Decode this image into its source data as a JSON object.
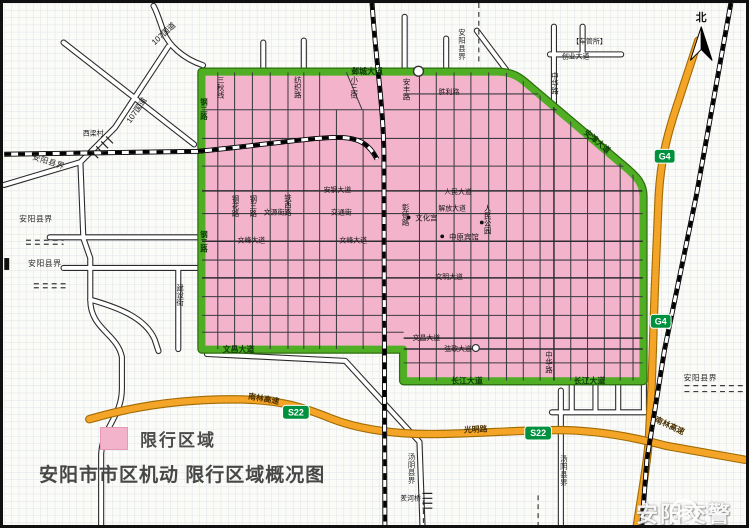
{
  "title": "安阳市市区机动 限行区域概况图",
  "legend": {
    "label": "限行区域",
    "swatch_color": "#f3b3cb"
  },
  "watermark": {
    "text": "安阳交警"
  },
  "compass": {
    "label": "北"
  },
  "map": {
    "colors": {
      "restricted_zone_fill": "#f3b3cb",
      "boundary_road_green": "#4fae24",
      "highway_orange": "#f4a427",
      "badge_green": "#00913f",
      "paper_grid": "#dee3e7"
    },
    "badges": [
      {
        "text": "G4",
        "x": 668,
        "y": 155
      },
      {
        "text": "G4",
        "x": 664,
        "y": 322
      },
      {
        "text": "S22",
        "x": 295,
        "y": 414
      },
      {
        "text": "S22",
        "x": 540,
        "y": 435
      }
    ],
    "pois": [
      {
        "x": 409,
        "y": 217
      },
      {
        "x": 443,
        "y": 236
      },
      {
        "x": 483,
        "y": 222
      }
    ],
    "labels": [
      {
        "text": "107国道",
        "x": 163,
        "y": 33,
        "rot": -42,
        "c": "r"
      },
      {
        "text": "107国道",
        "x": 136,
        "y": 110,
        "rot": -55,
        "c": "r"
      },
      {
        "text": "西梁村",
        "x": 90,
        "y": 134,
        "c": "r t"
      },
      {
        "text": "安阳县界",
        "x": 44,
        "y": 163,
        "rot": 17,
        "c": "b"
      },
      {
        "text": "安阳县界",
        "x": 32,
        "y": 221,
        "c": "b"
      },
      {
        "text": "安阳县界",
        "x": 41,
        "y": 266,
        "c": "b"
      },
      {
        "text": "安阳县界",
        "x": 463,
        "y": 26,
        "v": 1,
        "c": "b"
      },
      {
        "text": "安阳县界",
        "x": 704,
        "y": 382,
        "c": "b"
      },
      {
        "text": "汤阴县界",
        "x": 412,
        "y": 455,
        "v": 1,
        "c": "b"
      },
      {
        "text": "汤阴县界",
        "x": 566,
        "y": 457,
        "v": 1,
        "c": "b"
      },
      {
        "text": "邺城大道",
        "x": 367,
        "y": 72,
        "c": "g"
      },
      {
        "text": "钢二路",
        "x": 202,
        "y": 96,
        "v": 1,
        "c": "g"
      },
      {
        "text": "钢二路",
        "x": 202,
        "y": 230,
        "v": 1,
        "c": "g"
      },
      {
        "text": "文昌大道",
        "x": 237,
        "y": 353,
        "c": "g"
      },
      {
        "text": "长江大道",
        "x": 468,
        "y": 385,
        "c": "g"
      },
      {
        "text": "长江大道",
        "x": 592,
        "y": 385,
        "c": "g"
      },
      {
        "text": "安漳大道",
        "x": 598,
        "y": 142,
        "rot": 40,
        "c": "g"
      },
      {
        "text": "中华路",
        "x": 557,
        "y": 70,
        "v": 1,
        "c": "r"
      },
      {
        "text": "中华路",
        "x": 551,
        "y": 352,
        "v": 1,
        "c": "r"
      },
      {
        "text": "安丰路",
        "x": 407,
        "y": 76,
        "v": 1,
        "c": "r"
      },
      {
        "text": "胜利路",
        "x": 450,
        "y": 92,
        "c": "r t"
      },
      {
        "text": "纺织路",
        "x": 297,
        "y": 74,
        "v": 1,
        "c": "r"
      },
      {
        "text": "三秋线",
        "x": 219,
        "y": 74,
        "v": 1,
        "c": "r"
      },
      {
        "text": "小三街",
        "x": 354,
        "y": 74,
        "v": 1,
        "c": "r"
      },
      {
        "text": "安钢大道",
        "x": 337,
        "y": 191,
        "c": "r t"
      },
      {
        "text": "人民大道",
        "x": 459,
        "y": 193,
        "c": "r t"
      },
      {
        "text": "解放大道",
        "x": 453,
        "y": 210,
        "c": "r t"
      },
      {
        "text": "文峰大道",
        "x": 250,
        "y": 242,
        "c": "r t"
      },
      {
        "text": "文峰大道",
        "x": 353,
        "y": 242,
        "c": "r t"
      },
      {
        "text": "文明大道",
        "x": 450,
        "y": 279,
        "c": "r t"
      },
      {
        "text": "文昌大道",
        "x": 427,
        "y": 341,
        "c": "r t"
      },
      {
        "text": "弦歌大道",
        "x": 459,
        "y": 352,
        "c": "r t"
      },
      {
        "text": "文源街",
        "x": 273,
        "y": 214,
        "c": "r t"
      },
      {
        "text": "交通街",
        "x": 341,
        "y": 214,
        "c": "r t"
      },
      {
        "text": "铁西路",
        "x": 287,
        "y": 193,
        "v": 1,
        "c": "r"
      },
      {
        "text": "彰德路",
        "x": 406,
        "y": 203,
        "v": 1,
        "c": "r"
      },
      {
        "text": "钢花路",
        "x": 234,
        "y": 194,
        "v": 1,
        "c": "r"
      },
      {
        "text": "钢三路",
        "x": 252,
        "y": 194,
        "v": 1,
        "c": "r"
      },
      {
        "text": "建设街",
        "x": 178,
        "y": 284,
        "v": 1,
        "c": "r"
      },
      {
        "text": "光明路",
        "x": 477,
        "y": 434,
        "rot": -3,
        "c": "o"
      },
      {
        "text": "南林高速",
        "x": 262,
        "y": 403,
        "rot": 10,
        "c": "o"
      },
      {
        "text": "南林高速",
        "x": 672,
        "y": 430,
        "rot": 25,
        "c": "o"
      },
      {
        "text": "文化宫",
        "x": 427,
        "y": 220,
        "c": "p"
      },
      {
        "text": "中原宾馆",
        "x": 465,
        "y": 239,
        "c": "p"
      },
      {
        "text": "人民公园",
        "x": 489,
        "y": 204,
        "v": 1,
        "c": "p"
      },
      {
        "text": "羑河桥",
        "x": 411,
        "y": 503,
        "c": "r t"
      },
      {
        "text": "【车管所】",
        "x": 592,
        "y": 41,
        "c": "r t"
      },
      {
        "text": "创业大道",
        "x": 578,
        "y": 56,
        "c": "r t"
      }
    ]
  }
}
